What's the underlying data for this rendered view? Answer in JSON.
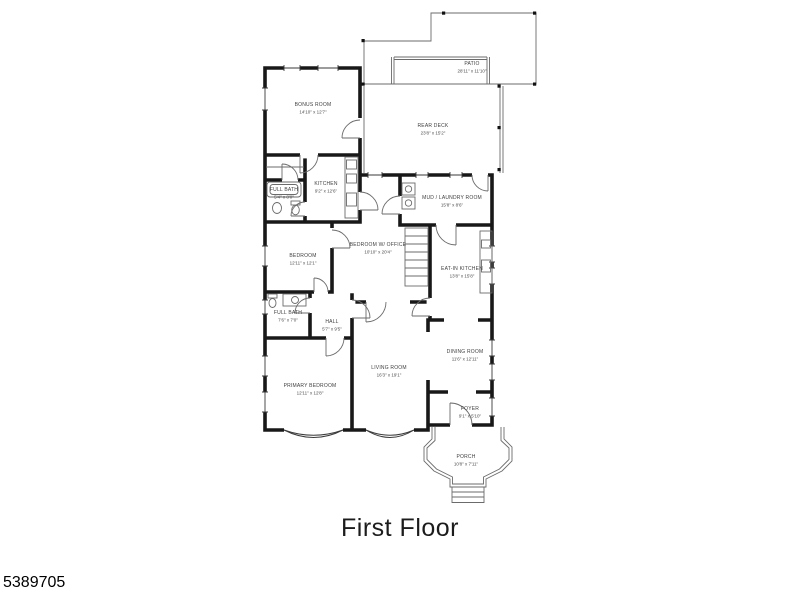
{
  "title": "First Floor",
  "listing_id": "5389705",
  "colors": {
    "wall": "#181818",
    "thin_line": "#6b6b6b",
    "label_text": "#3f3f3f"
  },
  "rooms": [
    {
      "name": "PATIO",
      "dims": "28'11\" x 11'10\""
    },
    {
      "name": "REAR DECK",
      "dims": "23'8\" x 15'2\""
    },
    {
      "name": "BONUS ROOM",
      "dims": "14'10\" x 12'7\""
    },
    {
      "name": "KITCHEN",
      "dims": "9'2\" x 12'6\""
    },
    {
      "name": "FULL BATH",
      "dims": "5'4\" x 8'0\""
    },
    {
      "name": "MUD / LAUNDRY ROOM",
      "dims": "15'8\" x 8'6\""
    },
    {
      "name": "BEDROOM",
      "dims": "12'11\" x 12'1\""
    },
    {
      "name": "BEDROOM W/ OFFICE",
      "dims": "10'10\" x 20'4\""
    },
    {
      "name": "EAT-IN KITCHEN",
      "dims": "13'8\" x 15'8\""
    },
    {
      "name": "FULL BATH",
      "dims": "7'6\" x 7'0\""
    },
    {
      "name": "HALL",
      "dims": "5'7\" x 9'5\""
    },
    {
      "name": "DINING ROOM",
      "dims": "11'6\" x 12'11\""
    },
    {
      "name": "LIVING ROOM",
      "dims": "16'3\" x 19'1\""
    },
    {
      "name": "PRIMARY BEDROOM",
      "dims": "12'11\" x 12'8\""
    },
    {
      "name": "FOYER",
      "dims": "9'1\" x 5'10\""
    },
    {
      "name": "PORCH",
      "dims": "10'8\" x 7'11\""
    }
  ]
}
